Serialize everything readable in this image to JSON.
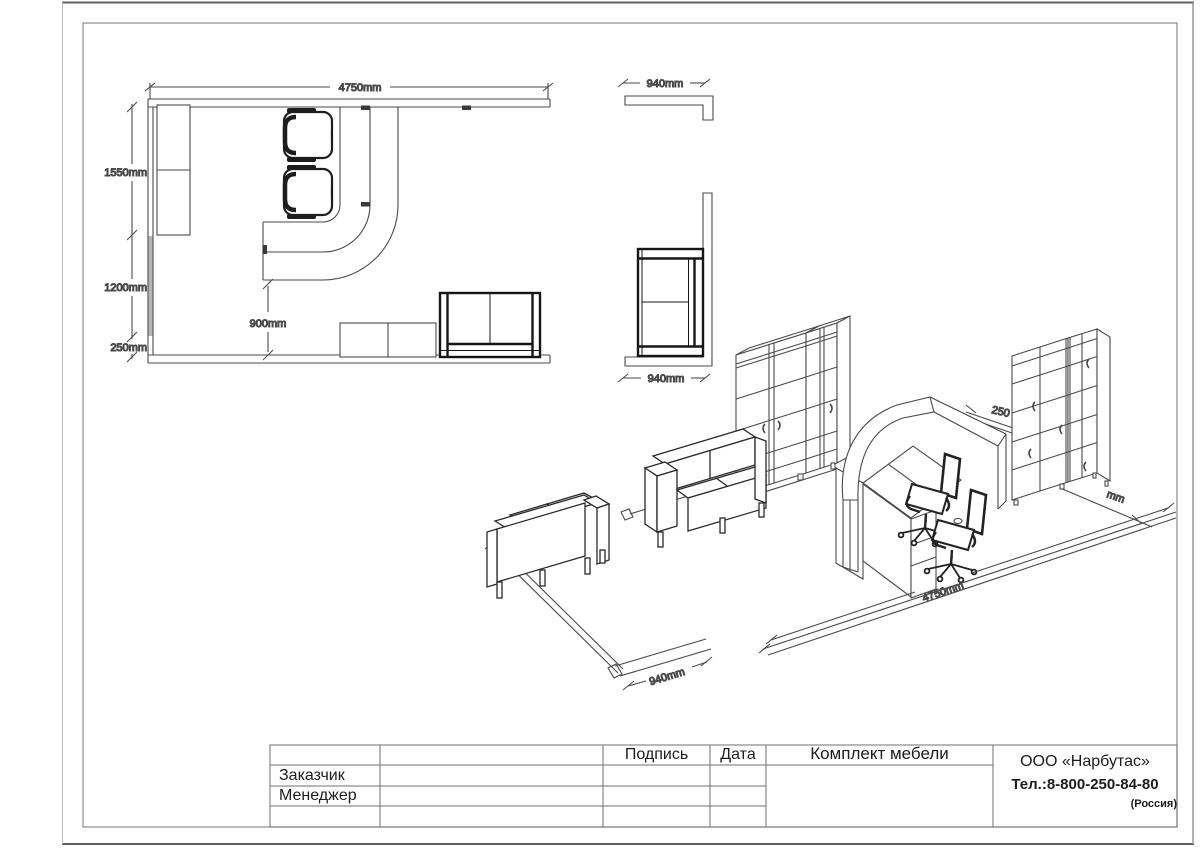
{
  "sheet": {
    "plan": {
      "width_total": "4750mm",
      "left_upper": "1550mm",
      "left_middle": "1200mm",
      "left_lower": "250mm",
      "desk_to_wall": "900mm"
    },
    "wall_section": {
      "width": "940mm"
    },
    "corner_section": {
      "width": "940mm"
    },
    "iso": {
      "front_width": "4750mm",
      "side_width": "940mm",
      "gap_partial": "250",
      "depth_partial": "mm"
    },
    "title_block": {
      "signature_col": "Подпись",
      "date_col": "Дата",
      "customer_row": "Заказчик",
      "manager_row": "Менеджер",
      "project_title": "Комплект мебели",
      "company_name": "ООО «Нарбутас»",
      "company_phone": "Тел.:8-800-250-84-80",
      "company_country": "(Россия)"
    }
  }
}
